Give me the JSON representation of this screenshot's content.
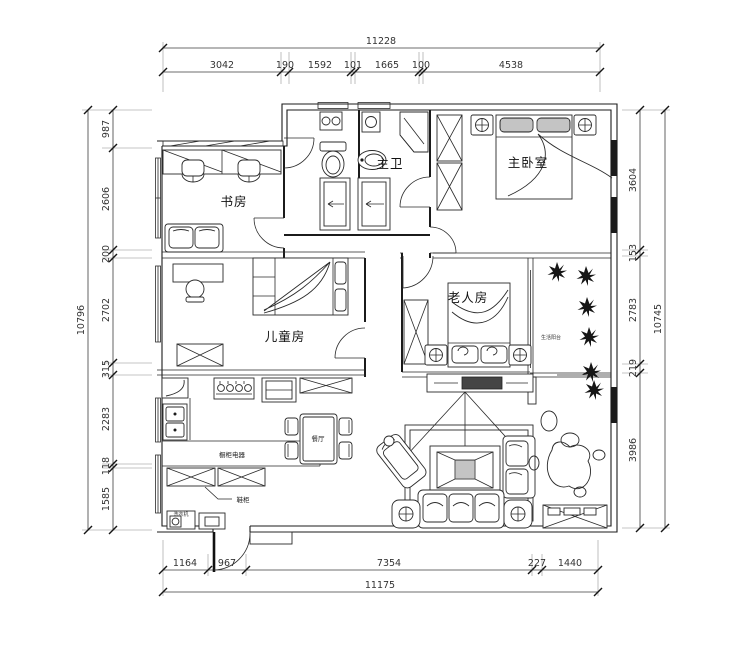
{
  "plan": {
    "type": "apartment-floor-plan",
    "colors": {
      "line": "#1b1b1b",
      "dim_text": "#333333",
      "background": "#ffffff"
    },
    "rooms": {
      "study": "书房",
      "master_bath": "主卫",
      "master_bedroom": "主卧室",
      "kids_room": "儿童房",
      "elder_room": "老人房",
      "balcony": "生活阳台",
      "dining": "餐厅",
      "kitchen_counter": "橱柜电器",
      "shoe_cabinet": "鞋柜",
      "laundry": "洗衣机"
    },
    "dims": {
      "top": {
        "total": "11228",
        "segments": [
          "3042",
          "190",
          "1592",
          "101",
          "1665",
          "100",
          "4538"
        ]
      },
      "bottom": {
        "total": "11175",
        "segments": [
          "1164",
          "967",
          "7354",
          "227",
          "1440"
        ]
      },
      "left": {
        "total": "10796",
        "segments": [
          "987",
          "2606",
          "200",
          "2702",
          "315",
          "2283",
          "118",
          "1585"
        ]
      },
      "right": {
        "total": "10745",
        "segments": [
          "3604",
          "153",
          "2783",
          "219",
          "3986"
        ]
      }
    }
  }
}
